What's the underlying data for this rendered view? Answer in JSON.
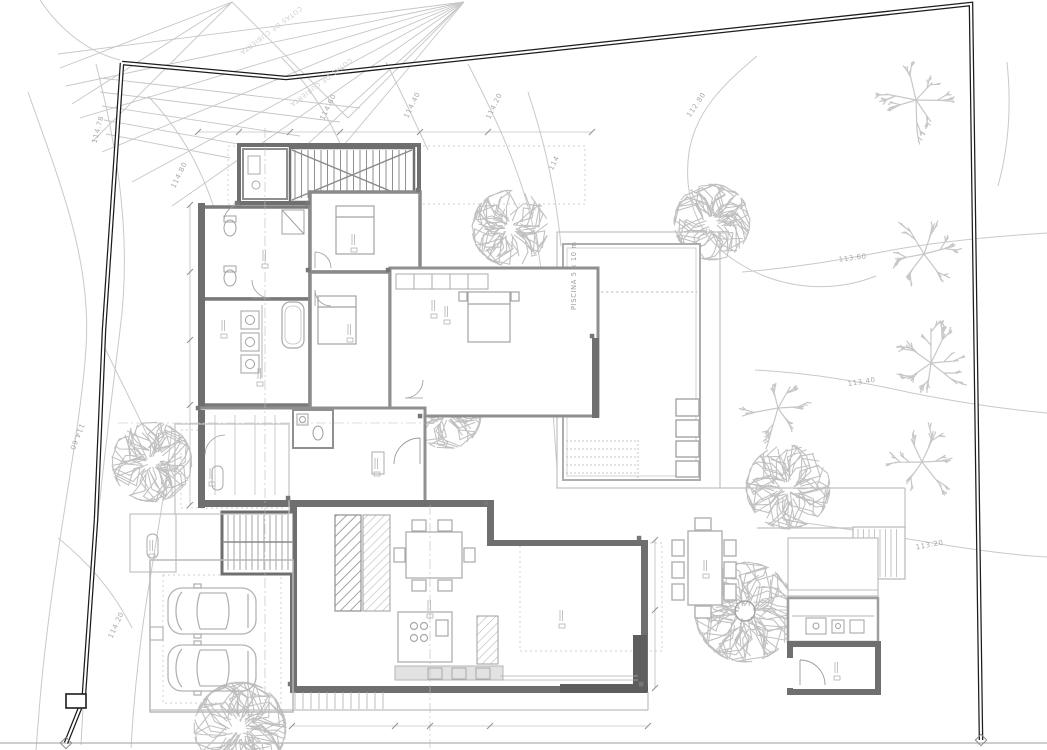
{
  "plan": {
    "pool_label": "PISCINA 5 x 10 m",
    "roof_note": "COTAS DE CUBIERTA",
    "contour_labels": [
      {
        "text": "114.78",
        "x": 100,
        "y": 130,
        "rot": -75
      },
      {
        "text": "114.80",
        "x": 181,
        "y": 176,
        "rot": -64
      },
      {
        "text": "114.60",
        "x": 330,
        "y": 108,
        "rot": -64
      },
      {
        "text": "114.40",
        "x": 414,
        "y": 106,
        "rot": -64
      },
      {
        "text": "114.20",
        "x": 496,
        "y": 107,
        "rot": -64
      },
      {
        "text": "114",
        "x": 556,
        "y": 164,
        "rot": -64
      },
      {
        "text": "112.80",
        "x": 698,
        "y": 106,
        "rot": -56
      },
      {
        "text": "113.60",
        "x": 853,
        "y": 260,
        "rot": -7
      },
      {
        "text": "113.40",
        "x": 862,
        "y": 384,
        "rot": -9
      },
      {
        "text": "113.20",
        "x": 930,
        "y": 547,
        "rot": -11
      },
      {
        "text": "114.60",
        "x": 75,
        "y": 436,
        "rot": 112
      },
      {
        "text": "114.20",
        "x": 118,
        "y": 626,
        "rot": -65
      }
    ],
    "colors": {
      "boundary": "#1c1c1c",
      "wall_dark": "#6b6b6b",
      "wall_mid": "#8f8f8f",
      "wall_light": "#b5b5b5",
      "contour": "#c9c9c9",
      "tree": "#c0c0c0"
    }
  }
}
